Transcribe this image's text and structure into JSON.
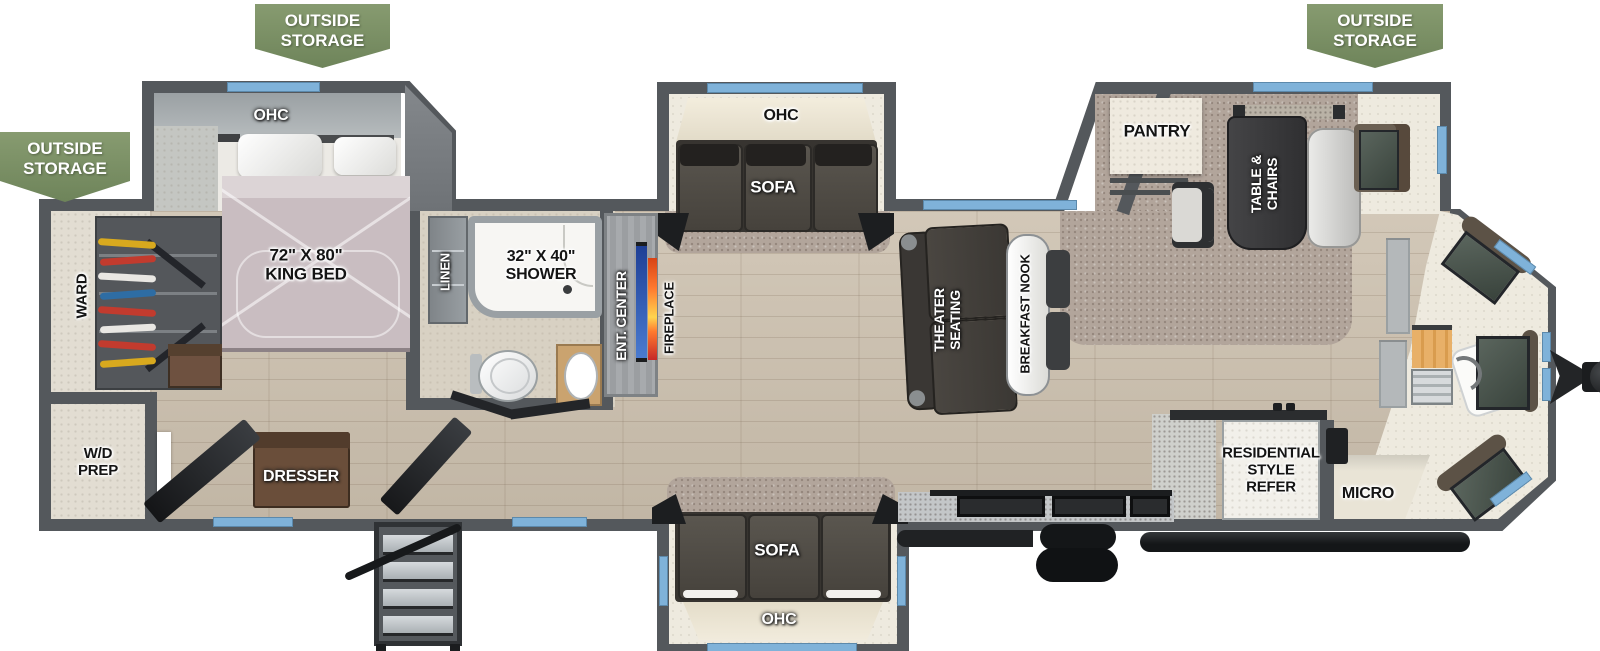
{
  "banner": {
    "outside_storage": "OUTSIDE\nSTORAGE"
  },
  "labels": {
    "ohc": "OHC",
    "king_bed": "72\" X 80\"\nKING BED",
    "ward": "WARD",
    "wd_prep": "W/D\nPREP",
    "dresser": "DRESSER",
    "linen": "LINEN",
    "shower": "32\" X 40\"\nSHOWER",
    "ent_center": "ENT. CENTER",
    "fireplace": "FIREPLACE",
    "sofa": "SOFA",
    "theater_seating": "THEATER\nSEATING",
    "breakfast_nook": "BREAKFAST NOOK",
    "pantry": "PANTRY",
    "table_chairs": "TABLE &\nCHAIRS",
    "refer": "RESIDENTIAL\nSTYLE\nREFER",
    "micro": "MICRO"
  },
  "colors": {
    "banner_green": "#7c9166",
    "wall_gray": "#54585c",
    "window_blue": "#7fb2d9",
    "tv_blue": "#2d5fc0",
    "fireplace_orange": "#ff7a2f",
    "floor_wood": "#ccc0ae",
    "carpet_taupe": "#b2a59b",
    "mattress": "#c9bdc1"
  }
}
